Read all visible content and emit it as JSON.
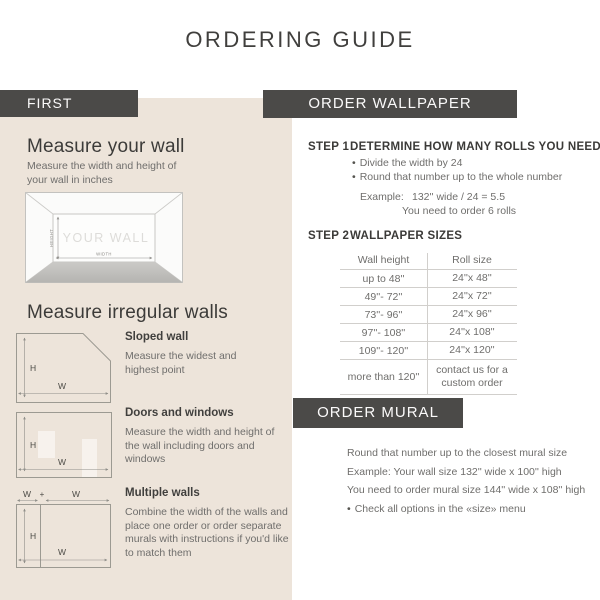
{
  "title": "ORDERING GUIDE",
  "glyphs": {
    "bullet": "•",
    "plus": "+"
  },
  "colors": {
    "accent_dark": "#4b4a48",
    "panel_beige": "#ede4da",
    "heading_text": "#3c3b39",
    "body_text": "#6f6e6c",
    "diagram_line": "#9c9a92",
    "table_line": "#d1cfcc",
    "floor_gray": "#bfbebb"
  },
  "first": {
    "header": "FIRST",
    "measure_wall_heading": "Measure your wall",
    "measure_wall_description": "Measure the width and height of your wall in inches",
    "wall_diagram": {
      "wall_label": "YOUR WALL",
      "height_label": "HEIGHT",
      "width_label": "WIDTH"
    },
    "irregular_heading": "Measure irregular walls",
    "h_label": "H",
    "w_label": "W",
    "sloped": {
      "title": "Sloped wall",
      "description": "Measure the widest and highest point"
    },
    "doors": {
      "title": "Doors and windows",
      "description": "Measure the width and height of the wall including doors and windows"
    },
    "multiple": {
      "title": "Multiple walls",
      "description": "Combine the width of the walls and place one order or order separate murals with instructions if you'd like to match them"
    }
  },
  "order_wallpaper": {
    "header": "ORDER WALLPAPER",
    "step1_label": "STEP 1",
    "step1_title": "DETERMINE HOW MANY ROLLS YOU NEED",
    "step1_bullets": [
      "Divide the width by 24",
      "Round that number up to the whole number"
    ],
    "example_label": "Example:",
    "example_value": "132'' wide / 24 = 5.5",
    "example_result": "You need to order 6 rolls",
    "step2_label": "STEP 2",
    "step2_title": "WALLPAPER SIZES",
    "table": {
      "headers": [
        "Wall height",
        "Roll size"
      ],
      "rows": [
        {
          "wall_height": "up to 48''",
          "roll_size": "24''x 48''"
        },
        {
          "wall_height": "49''- 72''",
          "roll_size": "24''x 72''"
        },
        {
          "wall_height": "73''- 96''",
          "roll_size": "24''x 96''"
        },
        {
          "wall_height": "97''- 108''",
          "roll_size": "24''x 108''"
        },
        {
          "wall_height": "109''- 120''",
          "roll_size": "24''x 120''"
        },
        {
          "wall_height": "more than 120''",
          "roll_size": "contact us for a custom order"
        }
      ]
    }
  },
  "order_mural": {
    "header": "ORDER MURAL",
    "line1": "Round that number up to the closest mural size",
    "line2": "Example: Your wall size 132'' wide x 100'' high",
    "line3": "You need to order mural size 144'' wide x 108'' high",
    "bullet_line": "Check all options in the «size» menu"
  }
}
